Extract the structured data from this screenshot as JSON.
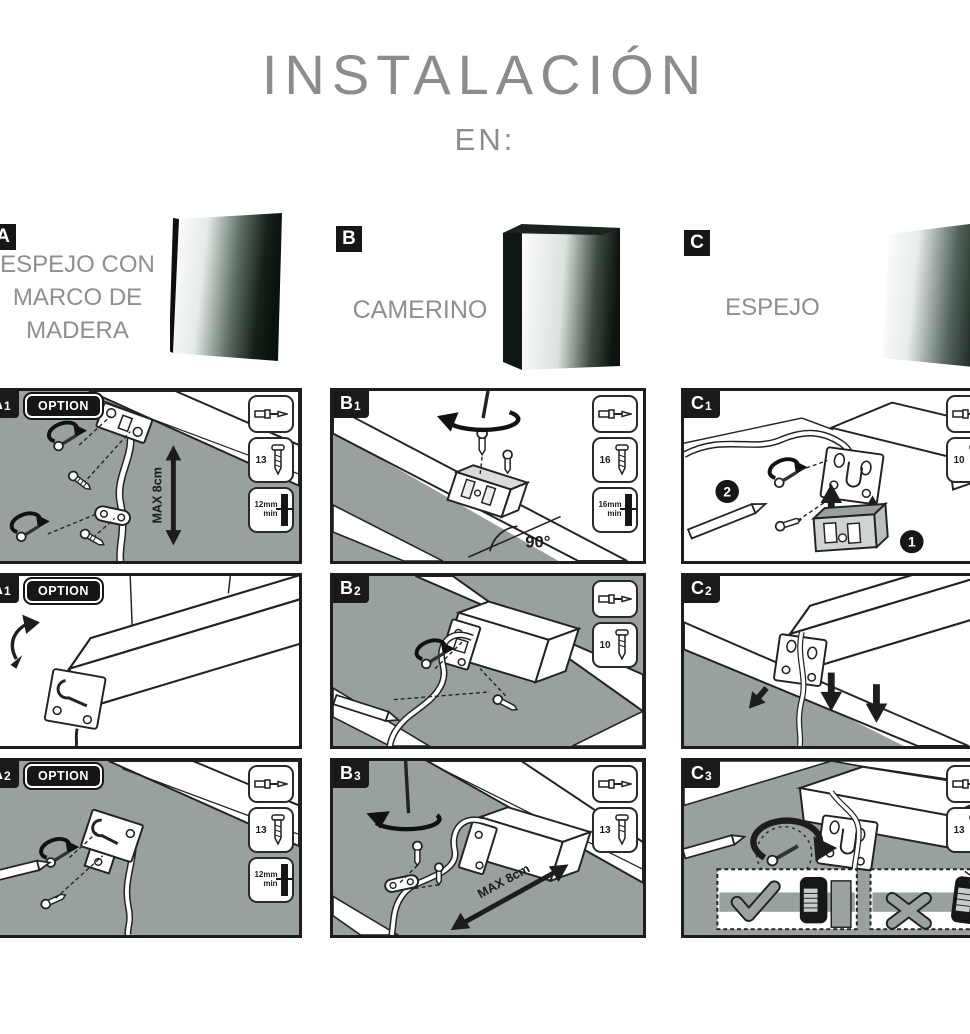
{
  "title": "INSTALACIÓN",
  "subtitle": "EN:",
  "colors": {
    "panel_gray": "#98a19f",
    "line_dark": "#222222",
    "badge_black": "#161616",
    "title_gray": "#8c8c8c",
    "mirror_dark": "#0b130e"
  },
  "products": {
    "a": {
      "badge": "A",
      "label": "ESPEJO CON\nMARCO DE\nMADERA"
    },
    "b": {
      "badge": "B",
      "label": "CAMERINO"
    },
    "c": {
      "badge": "C",
      "label": "ESPEJO"
    }
  },
  "panels": {
    "a1": {
      "letter": "A",
      "num": "1",
      "option": "OPTION",
      "max": "MAX 8cm",
      "screw": "13",
      "wall": "12mm\nmin"
    },
    "b1": {
      "letter": "B",
      "num": "1",
      "angle": "90°",
      "screw": "16",
      "wall": "16mm\nmin"
    },
    "c1": {
      "letter": "C",
      "num": "1",
      "screw": "10",
      "step1": "1",
      "step2": "2"
    },
    "a1b": {
      "letter": "A",
      "num": "1",
      "option": "OPTION"
    },
    "b2": {
      "letter": "B",
      "num": "2",
      "screw": "10"
    },
    "c2": {
      "letter": "C",
      "num": "2"
    },
    "a2": {
      "letter": "A",
      "num": "2",
      "option": "OPTION",
      "screw": "13",
      "wall": "12mm\nmin"
    },
    "b3": {
      "letter": "B",
      "num": "3",
      "max": "MAX 8cm",
      "screw": "13"
    },
    "c3": {
      "letter": "C",
      "num": "3",
      "screw": "13"
    }
  }
}
